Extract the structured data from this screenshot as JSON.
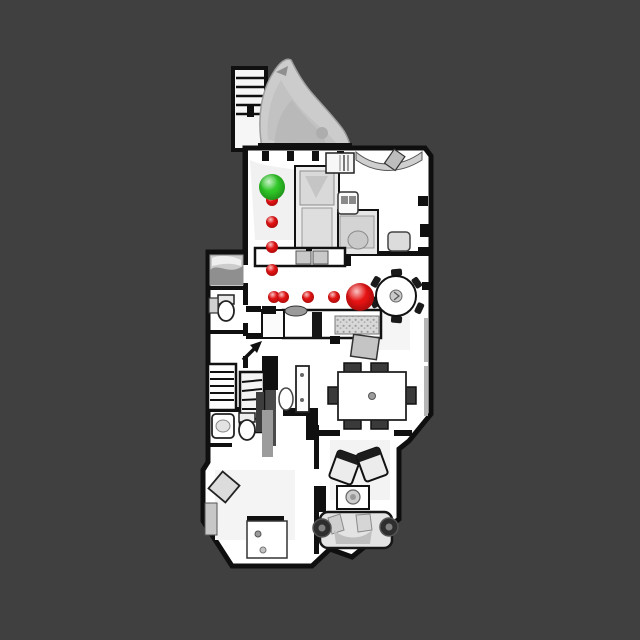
{
  "scene": {
    "background_color": "#404040",
    "floor_color": "#ffffff",
    "wall_color": "#101010",
    "artifact_color": "#cccccc"
  },
  "markers": {
    "start": {
      "x": 272,
      "y": 187,
      "r": 13,
      "color": "#2fc628",
      "edge": "#156f0e"
    },
    "goal": {
      "x": 360,
      "y": 297,
      "r": 14,
      "color": "#e61313",
      "edge": "#7a0707"
    },
    "waypoint_color": "#e01212",
    "waypoint_edge": "#8a0606",
    "waypoints": [
      {
        "x": 272,
        "y": 200,
        "r": 6
      },
      {
        "x": 272,
        "y": 222,
        "r": 6
      },
      {
        "x": 272,
        "y": 247,
        "r": 6
      },
      {
        "x": 272,
        "y": 270,
        "r": 6
      },
      {
        "x": 274,
        "y": 297,
        "r": 6
      },
      {
        "x": 283,
        "y": 297,
        "r": 6
      },
      {
        "x": 308,
        "y": 297,
        "r": 6
      },
      {
        "x": 334,
        "y": 297,
        "r": 6
      }
    ]
  }
}
